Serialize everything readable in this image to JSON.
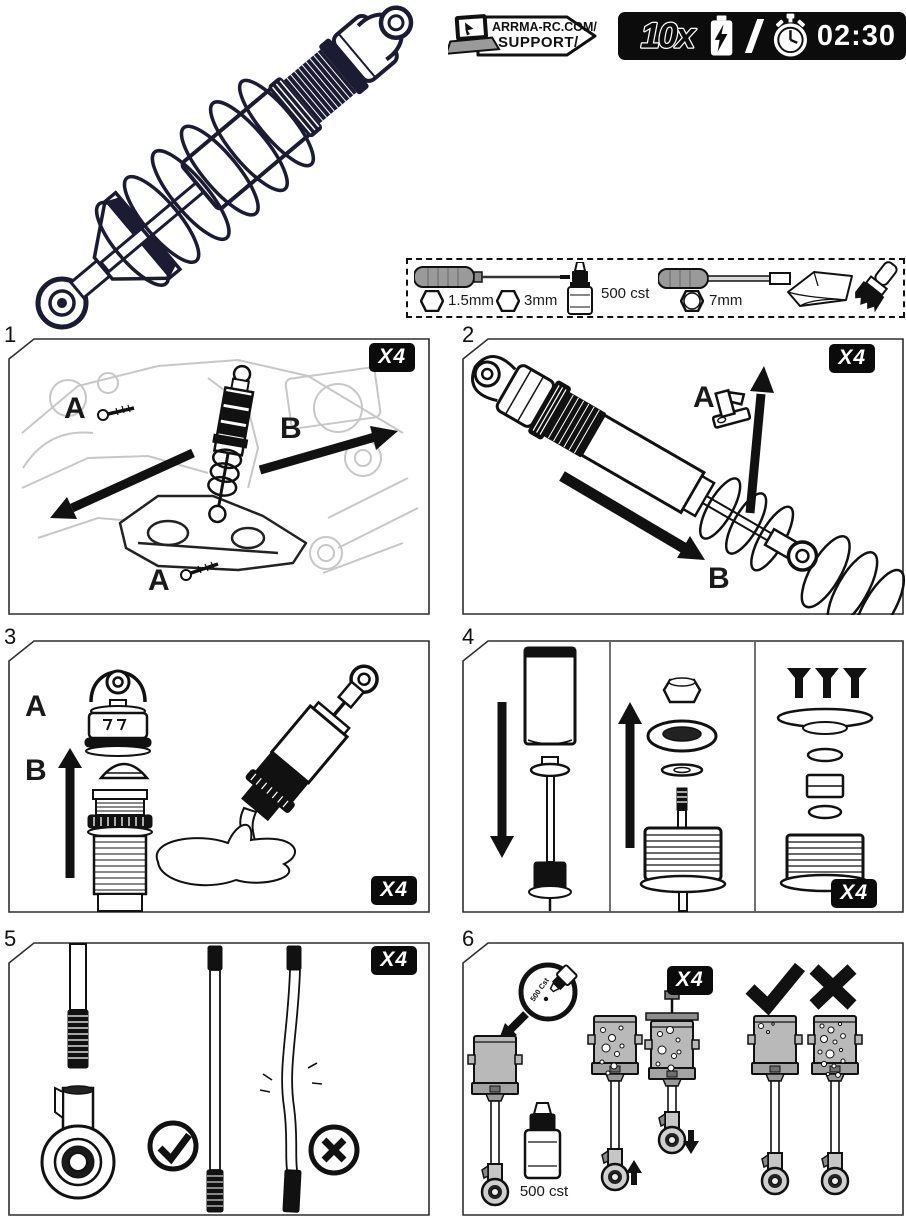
{
  "header": {
    "support": {
      "line1": "ARRMA-RC.COM/",
      "line2": "SUPPORT/"
    },
    "repeat_count": "10x",
    "timer": "02:30"
  },
  "tools": {
    "hex_driver_1": "1.5mm",
    "hex_driver_2": "3mm",
    "oil": "500 cst",
    "nut_driver": "7mm"
  },
  "steps": {
    "s1": {
      "num": "1",
      "qty": "X4",
      "label_a_top": "A",
      "label_b": "B",
      "label_a_bottom": "A"
    },
    "s2": {
      "num": "2",
      "qty": "X4",
      "label_a": "A",
      "label_b": "B"
    },
    "s3": {
      "num": "3",
      "qty": "X4",
      "label_a": "A",
      "label_b": "B"
    },
    "s4": {
      "num": "4",
      "qty": "X4"
    },
    "s5": {
      "num": "5",
      "qty": "X4"
    },
    "s6": {
      "num": "6",
      "qty": "X4",
      "magnifier_oil": "500 Cst",
      "oil_label": "500 cst"
    }
  },
  "colors": {
    "line_art_navy": "#1b1b33",
    "badge_black": "#0c0c0c",
    "part_gray": "#b9b9b9",
    "ink": "#111111"
  }
}
